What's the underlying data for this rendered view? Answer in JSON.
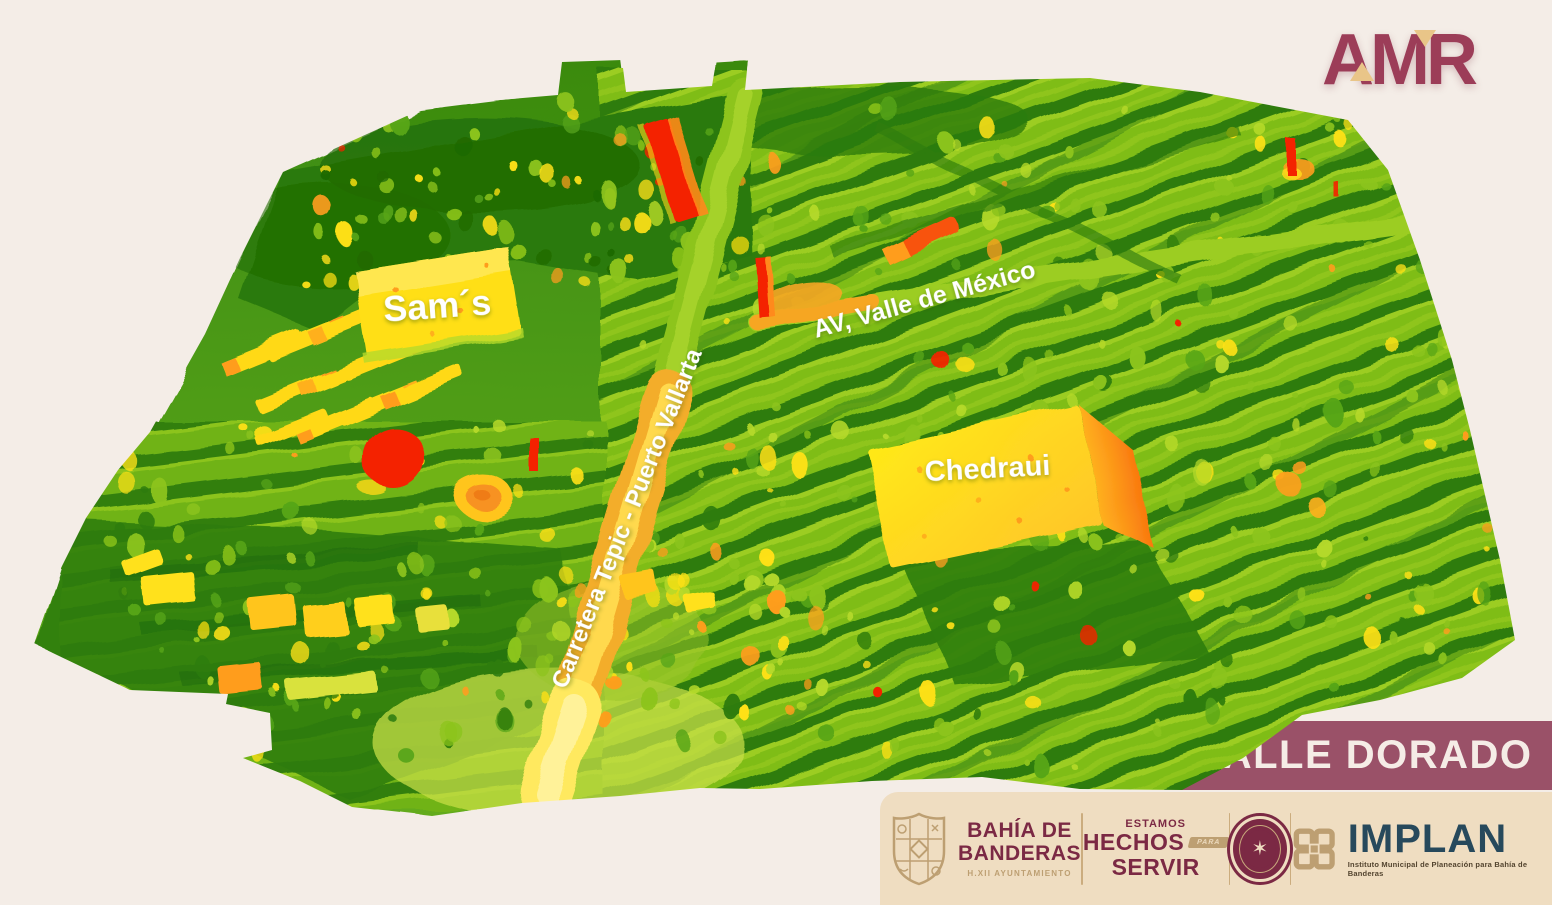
{
  "brand": {
    "logo_text": "AMR",
    "logo_color": "#9c3d58",
    "logo_accent": "#e9c588"
  },
  "banner": {
    "title": "VALLE DORADO",
    "color": "#9a5168",
    "text_color": "#f5ece6"
  },
  "map": {
    "labels": {
      "sams": "Sam´s",
      "chedraui": "Chedraui",
      "avenue": "AV, Valle de México",
      "highway": "Carretera Tepic - Puerto Vallarta"
    },
    "palette": {
      "forest": "#1f6a04",
      "low": "#2e7c0e",
      "mid": "#57a518",
      "lime": "#8cc41c",
      "lime_light": "#b5d92a",
      "yellow": "#ffe115",
      "orange": "#ff9d1e",
      "red": "#f42300"
    }
  },
  "footer": {
    "municipality": {
      "name_line1": "BAHÍA DE",
      "name_line2": "BANDERAS",
      "subtitle": "H.XII AYUNTAMIENTO"
    },
    "slogan": {
      "line1": "ESTAMOS",
      "line2": "HECHOS",
      "tag": "PARA",
      "line3": "SERVIR"
    },
    "badge_glyph": "✶",
    "implan": {
      "name": "IMPLAN",
      "tagline": "Instituto Municipal de Planeación para Bahía de Banderas"
    }
  }
}
